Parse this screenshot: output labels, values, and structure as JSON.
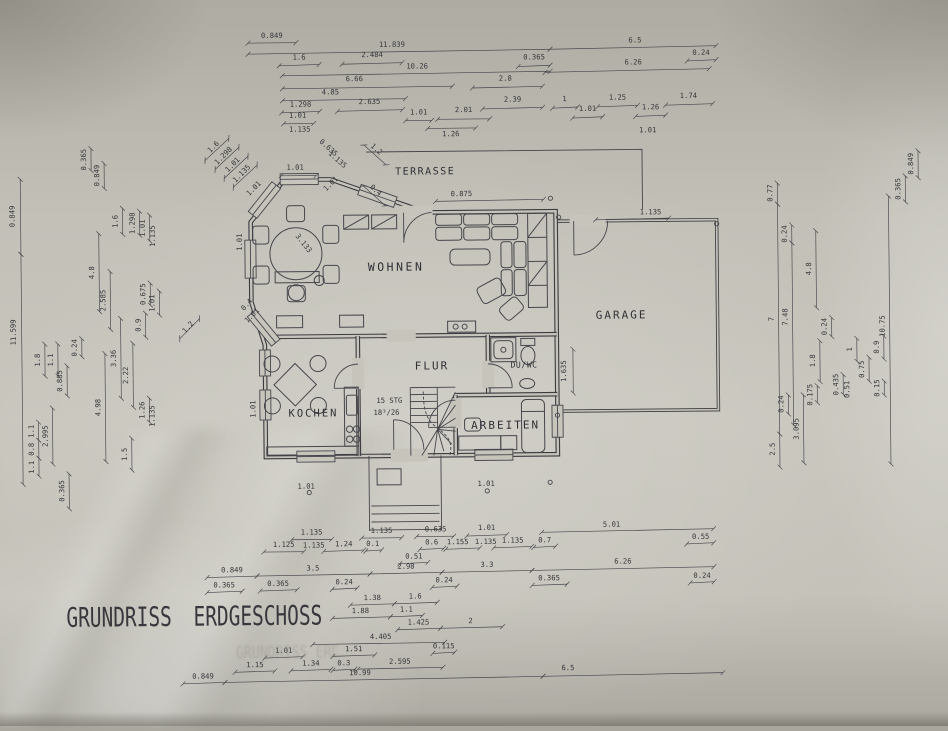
{
  "title": "GRUNDRISS ERDGESCHOSS",
  "ghost_title": "GRUNDRISS ERDGESCHOSS",
  "colors": {
    "paper": "#c6c4bb",
    "ink": "#3b3b40",
    "dim_text": "#36363b"
  },
  "rooms": [
    {
      "label": "TERRASSE",
      "x": 427,
      "y": 174,
      "fs": 10,
      "ls": 1.5
    },
    {
      "label": "WOHNEN",
      "x": 397,
      "y": 270,
      "fs": 11.5,
      "ls": 2.5
    },
    {
      "label": "GARAGE",
      "x": 622,
      "y": 320,
      "fs": 11,
      "ls": 2
    },
    {
      "label": "FLUR",
      "x": 432,
      "y": 369,
      "fs": 11,
      "ls": 2
    },
    {
      "label": "KOCHEN",
      "x": 313,
      "y": 415,
      "fs": 10.5,
      "ls": 2
    },
    {
      "label": "DU/WC",
      "x": 524,
      "y": 368,
      "fs": 8.2,
      "ls": 0.5
    },
    {
      "label": "ARBEITEN",
      "x": 505,
      "y": 429,
      "fs": 11,
      "ls": 2
    }
  ],
  "stairs_note": [
    {
      "text": "15 STG",
      "x": 389,
      "y": 402
    },
    {
      "text": "18³/26",
      "x": 386,
      "y": 414
    }
  ],
  "corner_markers": [
    [
      552,
      199
    ],
    [
      560,
      218
    ],
    [
      718,
      226
    ],
    [
      557,
      416
    ],
    [
      549,
      483
    ],
    [
      308,
      491
    ],
    [
      486,
      491
    ]
  ],
  "dims": [
    [
      "0.849",
      0,
      275,
      36,
      251,
      41,
      299,
      41
    ],
    [
      "11.839",
      0,
      395,
      46,
      251,
      52,
      553,
      50
    ],
    [
      "6.5",
      0,
      638,
      44,
      553,
      50,
      719,
      48
    ],
    [
      "1.6",
      0,
      302,
      58,
      282,
      64,
      322,
      63
    ],
    [
      "2.484",
      0,
      375,
      56,
      345,
      63,
      405,
      62
    ],
    [
      "0.365",
      0,
      537,
      60,
      521,
      67,
      553,
      66
    ],
    [
      "0.24",
      0,
      704,
      57,
      690,
      63,
      719,
      62
    ],
    [
      "10.26",
      0,
      420,
      68,
      285,
      74,
      553,
      72
    ],
    [
      "6.26",
      0,
      636,
      66,
      548,
      73,
      712,
      71
    ],
    [
      "6.66",
      0,
      357,
      80,
      285,
      87,
      455,
      86
    ],
    [
      "2.8",
      0,
      508,
      81,
      475,
      88,
      545,
      87
    ],
    [
      "4.85",
      0,
      333,
      93,
      285,
      99,
      408,
      98
    ],
    [
      "1.298",
      0,
      303,
      105,
      284,
      111,
      322,
      110
    ],
    [
      "2.635",
      0,
      372,
      103,
      340,
      110,
      405,
      109
    ],
    [
      "2.39",
      0,
      515,
      102,
      485,
      109,
      545,
      108
    ],
    [
      "1",
      0,
      567,
      102,
      555,
      109,
      580,
      108
    ],
    [
      "1.25",
      0,
      620,
      101,
      600,
      108,
      640,
      107
    ],
    [
      "1.74",
      0,
      691,
      100,
      668,
      107,
      715,
      106
    ],
    [
      "1.01",
      0,
      421,
      114,
      408,
      120,
      434,
      120
    ],
    [
      "2.01",
      0,
      466,
      112,
      440,
      119,
      492,
      119
    ],
    [
      "1.01",
      0,
      590,
      112,
      575,
      119,
      605,
      118
    ],
    [
      "1.26",
      0,
      653,
      111,
      638,
      118,
      668,
      117
    ],
    [
      "1.01",
      0,
      300,
      116,
      286,
      122,
      316,
      122
    ],
    [
      "1.135",
      0,
      302,
      130
    ],
    [
      "1.26",
      0,
      453,
      136,
      430,
      128,
      478,
      128
    ],
    [
      "1.01",
      0,
      650,
      134
    ],
    [
      "1.6",
      -45,
      217,
      146,
      207,
      158,
      231,
      136
    ],
    [
      "1.298",
      -45,
      227,
      155,
      217,
      167,
      241,
      145
    ],
    [
      "1.01",
      -45,
      236,
      164,
      226,
      176,
      250,
      154
    ],
    [
      "1.135",
      -45,
      245,
      173,
      235,
      185,
      259,
      163
    ],
    [
      "0.635",
      42,
      329,
      148
    ],
    [
      "1.135",
      42,
      338,
      160
    ],
    [
      "1.2",
      42,
      377,
      150,
      366,
      144,
      388,
      164
    ],
    [
      "0.4",
      42,
      376,
      191,
      365,
      185,
      387,
      205
    ],
    [
      "1.2",
      -48,
      190,
      326,
      180,
      336,
      200,
      316
    ],
    [
      "3.133",
      52,
      303,
      243
    ],
    [
      "0.4",
      -48,
      249,
      304
    ],
    [
      "1.01",
      0,
      297,
      168,
      283,
      174,
      318,
      174
    ],
    [
      "1.01",
      -45,
      257,
      188
    ],
    [
      "1.01",
      -90,
      243,
      240
    ],
    [
      "1.01",
      -45,
      254,
      315
    ],
    [
      "1.01",
      -45,
      334,
      184
    ],
    [
      "1.01",
      -90,
      255,
      407
    ],
    [
      "0.875",
      0,
      463,
      196,
      437,
      201,
      545,
      200
    ],
    [
      "1.135",
      0,
      652,
      216,
      597,
      221,
      670,
      220
    ],
    [
      "1.635",
      -90,
      566,
      372,
      573,
      350,
      573,
      394
    ],
    [
      "0.849",
      -90,
      16,
      212,
      22,
      175,
      22,
      250
    ],
    [
      "11.599",
      -90,
      16,
      328,
      22,
      250,
      22,
      480
    ],
    [
      "0.365",
      -90,
      63,
      487,
      68,
      470,
      68,
      505
    ],
    [
      "1.1",
      -90,
      33,
      427,
      38,
      418,
      38,
      436
    ],
    [
      "0.8",
      -90,
      33,
      445,
      38,
      436,
      38,
      454
    ],
    [
      "1.1",
      -90,
      33,
      463,
      38,
      454,
      38,
      472
    ],
    [
      "1.8",
      -90,
      40,
      356,
      45,
      340,
      45,
      372
    ],
    [
      "1.1",
      -90,
      53,
      356,
      58,
      340,
      58,
      372
    ],
    [
      "0.885",
      -90,
      62,
      377,
      67,
      362,
      67,
      392
    ],
    [
      "2.995",
      -90,
      47,
      432,
      52,
      404,
      52,
      460
    ],
    [
      "0.24",
      -90,
      77,
      344,
      82,
      335,
      82,
      353
    ],
    [
      "4.98",
      -90,
      100,
      404,
      105,
      350,
      105,
      458
    ],
    [
      "0.365",
      -90,
      88,
      156,
      93,
      145,
      93,
      167
    ],
    [
      "0.849",
      -90,
      101,
      172,
      106,
      160,
      106,
      185
    ],
    [
      "4.8",
      -90,
      95,
      269,
      100,
      230,
      100,
      308
    ],
    [
      "2.585",
      -90,
      106,
      297,
      111,
      268,
      111,
      326
    ],
    [
      "3.36",
      -90,
      116,
      355,
      121,
      315,
      121,
      395
    ],
    [
      "2.22",
      -90,
      128,
      372,
      133,
      340,
      133,
      404
    ],
    [
      "0.9",
      -90,
      141,
      322,
      146,
      310,
      146,
      334
    ],
    [
      "0.675",
      -90,
      146,
      291,
      151,
      280,
      151,
      302
    ],
    [
      "1.01",
      -90,
      155,
      300,
      160,
      288,
      160,
      312
    ],
    [
      "1.26",
      -90,
      144,
      407,
      149,
      395,
      149,
      419
    ],
    [
      "1.135",
      -90,
      154,
      413
    ],
    [
      "1.5",
      -90,
      126,
      451,
      131,
      435,
      131,
      467
    ],
    [
      "1.6",
      -90,
      119,
      218,
      124,
      205,
      124,
      231
    ],
    [
      "1.298",
      -90,
      136,
      220,
      141,
      208,
      141,
      232
    ],
    [
      "1.01",
      -90,
      146,
      225,
      151,
      212,
      151,
      238
    ],
    [
      "1.135",
      -90,
      156,
      233
    ],
    [
      "0.77",
      -90,
      774,
      196,
      779,
      186,
      779,
      207
    ],
    [
      "7",
      -90,
      774,
      322,
      779,
      207,
      779,
      437
    ],
    [
      "2.5",
      -90,
      774,
      452,
      779,
      437,
      779,
      470
    ],
    [
      "0.24",
      -90,
      783,
      407,
      788,
      398,
      788,
      417
    ],
    [
      "0.24",
      -90,
      788,
      237,
      793,
      228,
      793,
      246
    ],
    [
      "7.48",
      -90,
      788,
      320,
      793,
      246,
      793,
      428
    ],
    [
      "3.095",
      -90,
      798,
      432,
      803,
      398,
      803,
      466
    ],
    [
      "4.8",
      -90,
      812,
      272,
      817,
      234,
      817,
      311
    ],
    [
      "1.8",
      -90,
      815,
      364,
      820,
      344,
      820,
      385
    ],
    [
      "0.175",
      -90,
      812,
      398,
      817,
      389,
      817,
      406
    ],
    [
      "0.24",
      -90,
      827,
      330,
      832,
      321,
      832,
      340
    ],
    [
      "0.435",
      -90,
      838,
      388,
      843,
      378,
      843,
      398
    ],
    [
      "0.51",
      -90,
      849,
      393
    ],
    [
      "1",
      -90,
      852,
      353,
      857,
      342,
      857,
      365
    ],
    [
      "0.75",
      -90,
      864,
      373,
      869,
      361,
      869,
      385
    ],
    [
      "0.9",
      -90,
      879,
      351,
      884,
      340,
      884,
      363
    ],
    [
      "0.15",
      -90,
      879,
      392,
      884,
      385,
      884,
      399
    ],
    [
      "10.75",
      -90,
      885,
      330,
      890,
      200,
      890,
      468
    ],
    [
      "0.365",
      -90,
      902,
      193,
      907,
      180,
      907,
      206
    ],
    [
      "0.849",
      -90,
      915,
      168,
      920,
      155,
      920,
      182
    ],
    [
      "1.01",
      0,
      305,
      487
    ],
    [
      "1.01",
      0,
      485,
      486
    ],
    [
      "1.135",
      0,
      310,
      533,
      290,
      538,
      330,
      538
    ],
    [
      "1.135",
      0,
      312,
      546
    ],
    [
      "1.135",
      0,
      380,
      532,
      360,
      537,
      400,
      537
    ],
    [
      "0.635",
      0,
      434,
      531,
      415,
      536,
      452,
      536
    ],
    [
      "1.01",
      0,
      485,
      530,
      465,
      536,
      505,
      535
    ],
    [
      "1.135",
      0,
      484,
      544
    ],
    [
      "5.01",
      0,
      610,
      528,
      540,
      533,
      712,
      531
    ],
    [
      "1.125",
      0,
      282,
      545,
      262,
      550,
      302,
      550
    ],
    [
      "1.24",
      0,
      342,
      545,
      322,
      550,
      362,
      549
    ],
    [
      "0.1",
      0,
      371,
      545,
      364,
      550,
      380,
      549
    ],
    [
      "0.6",
      0,
      430,
      544,
      418,
      549,
      442,
      548
    ],
    [
      "1.155",
      0,
      456,
      544,
      444,
      549,
      478,
      548
    ],
    [
      "1.135",
      0,
      511,
      543,
      492,
      548,
      530,
      547
    ],
    [
      "0.7",
      0,
      543,
      543,
      532,
      548,
      554,
      547
    ],
    [
      "0.55",
      0,
      699,
      541,
      685,
      546,
      712,
      545
    ],
    [
      "0.51",
      0,
      412,
      558,
      398,
      563,
      426,
      562
    ],
    [
      "0.849",
      0,
      230,
      570,
      205,
      575,
      255,
      574
    ],
    [
      "3.5",
      0,
      311,
      569,
      255,
      574,
      368,
      573
    ],
    [
      "2.98",
      0,
      404,
      568,
      368,
      573,
      440,
      572
    ],
    [
      "3.3",
      0,
      485,
      567,
      440,
      572,
      530,
      571
    ],
    [
      "6.26",
      0,
      621,
      565,
      530,
      571,
      712,
      569
    ],
    [
      "0.365",
      0,
      222,
      585,
      205,
      590,
      240,
      589
    ],
    [
      "0.365",
      0,
      276,
      584,
      258,
      589,
      295,
      588
    ],
    [
      "0.24",
      0,
      342,
      583,
      330,
      588,
      355,
      587
    ],
    [
      "0.24",
      0,
      442,
      582,
      430,
      587,
      455,
      586
    ],
    [
      "0.365",
      0,
      547,
      581,
      530,
      586,
      565,
      585
    ],
    [
      "0.24",
      0,
      700,
      580,
      688,
      585,
      712,
      584
    ],
    [
      "1.38",
      0,
      370,
      599,
      348,
      604,
      392,
      603
    ],
    [
      "1.6",
      0,
      413,
      598,
      392,
      603,
      435,
      602
    ],
    [
      "1.88",
      0,
      358,
      612,
      330,
      617,
      388,
      616
    ],
    [
      "1.1",
      0,
      404,
      611,
      388,
      616,
      420,
      615
    ],
    [
      "1.425",
      0,
      416,
      624,
      395,
      629,
      438,
      628
    ],
    [
      "2",
      0,
      468,
      623,
      438,
      628,
      500,
      627
    ],
    [
      "4.405",
      0,
      378,
      638,
      310,
      643,
      442,
      642
    ],
    [
      "1.01",
      0,
      281,
      651,
      262,
      656,
      300,
      655
    ],
    [
      "1.51",
      0,
      351,
      650,
      330,
      655,
      372,
      654
    ],
    [
      "0.115",
      0,
      441,
      648,
      430,
      653,
      452,
      652
    ],
    [
      "1.15",
      0,
      252,
      665,
      232,
      670,
      272,
      669
    ],
    [
      "1.34",
      0,
      308,
      664,
      288,
      669,
      328,
      668
    ],
    [
      "0.3",
      0,
      341,
      664,
      330,
      669,
      352,
      668
    ],
    [
      "2.595",
      0,
      397,
      663,
      355,
      668,
      440,
      667
    ],
    [
      "0.849",
      0,
      200,
      676,
      180,
      681,
      222,
      680
    ],
    [
      "10.99",
      0,
      357,
      674,
      222,
      680,
      540,
      677
    ],
    [
      "6.5",
      0,
      565,
      671,
      540,
      677,
      720,
      675
    ]
  ]
}
